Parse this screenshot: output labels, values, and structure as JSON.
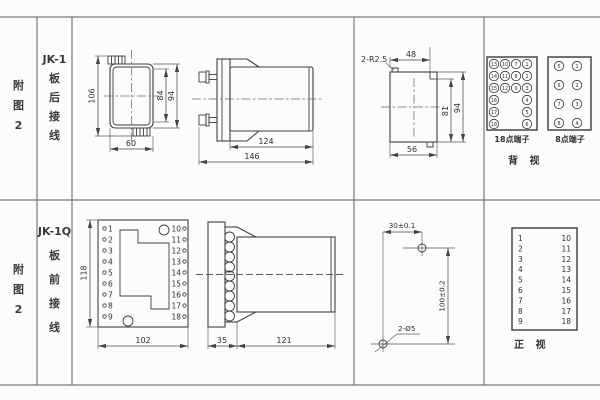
{
  "colors": {
    "line": "#3f3f3f",
    "grid": "#6e6e6e",
    "text": "#2e2e2e",
    "background": "#fcfcfc"
  },
  "top_row": {
    "figure_label": {
      "c1": "附",
      "c2": "图",
      "c3": "2"
    },
    "model": {
      "name": "JK-1",
      "c1": "板",
      "c2": "后",
      "c3": "接",
      "c4": "线"
    },
    "front_view": {
      "height_overall": "106",
      "height_inner": "84",
      "height_outer": "94",
      "width": "60"
    },
    "side_view": {
      "depth_body": "124",
      "depth_total": "146"
    },
    "cutout": {
      "corner_label": "2-R2.5",
      "top_width": "48",
      "height_inner": "81",
      "height": "94",
      "width": "56"
    },
    "terminals18": {
      "label": "18点端子",
      "grid": [
        [
          "13",
          "10",
          "7",
          "1"
        ],
        [
          "14",
          "11",
          "8",
          "2"
        ],
        [
          "15",
          "12",
          "9",
          "3"
        ],
        [
          "16",
          "4"
        ],
        [
          "17",
          "5"
        ],
        [
          "18",
          "6"
        ]
      ]
    },
    "terminals8": {
      "label": "8点端子",
      "grid": [
        [
          "5",
          "1"
        ],
        [
          "6",
          "2"
        ],
        [
          "7",
          "3"
        ],
        [
          "8",
          "4"
        ]
      ]
    },
    "view_label": "背  视"
  },
  "bottom_row": {
    "figure_label": {
      "c1": "附",
      "c2": "图",
      "c3": "2"
    },
    "model": {
      "name": "JK-1Q",
      "c1": "板",
      "c2": "前",
      "c3": "接",
      "c4": "线"
    },
    "front_view": {
      "height": "118",
      "width": "102",
      "left_terminals": [
        "1",
        "2",
        "3",
        "4",
        "5",
        "6",
        "7",
        "8",
        "9"
      ],
      "right_terminals": [
        "10",
        "11",
        "12",
        "13",
        "14",
        "15",
        "16",
        "17",
        "18"
      ]
    },
    "side_view": {
      "panel_depth": "35",
      "body_depth": "121"
    },
    "drill": {
      "h_spacing": "30±0.1",
      "v_spacing": "100±0.2",
      "holes": "2-Ø5"
    },
    "table": {
      "left": [
        "1",
        "2",
        "3",
        "4",
        "5",
        "6",
        "7",
        "8",
        "9"
      ],
      "right": [
        "10",
        "11",
        "12",
        "13",
        "14",
        "15",
        "16",
        "17",
        "18"
      ]
    },
    "view_label": "正  视"
  }
}
